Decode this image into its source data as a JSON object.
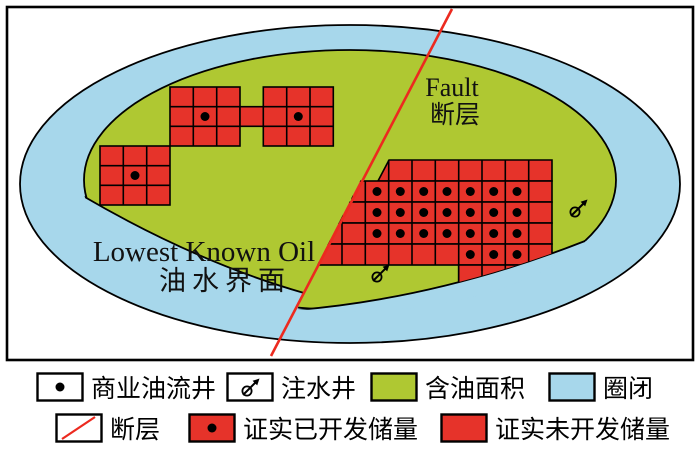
{
  "diagram": {
    "fault_label_en": "Fault",
    "fault_label_zh": "断层",
    "lko_label_en": "Lowest Known Oil",
    "lko_label_zh": "油水界面"
  },
  "legend": {
    "items": [
      {
        "symbol": "commercial-oil-well",
        "label": "商业油流井"
      },
      {
        "symbol": "injection-well",
        "label": "注水井"
      },
      {
        "symbol": "oil-bearing-area",
        "label": "含油面积"
      },
      {
        "symbol": "trap",
        "label": "圈闭"
      },
      {
        "symbol": "fault",
        "label": "断层"
      },
      {
        "symbol": "proved-developed-reserves",
        "label": "证实已开发储量"
      },
      {
        "symbol": "proved-undeveloped-reserves",
        "label": "证实未开发储量"
      }
    ]
  },
  "colors": {
    "oil_green": "#afc832",
    "water_blue": "#a7d7eb",
    "reserve_red": "#e6332a",
    "fault_red": "#ec2a1f",
    "line_black": "#000000"
  }
}
